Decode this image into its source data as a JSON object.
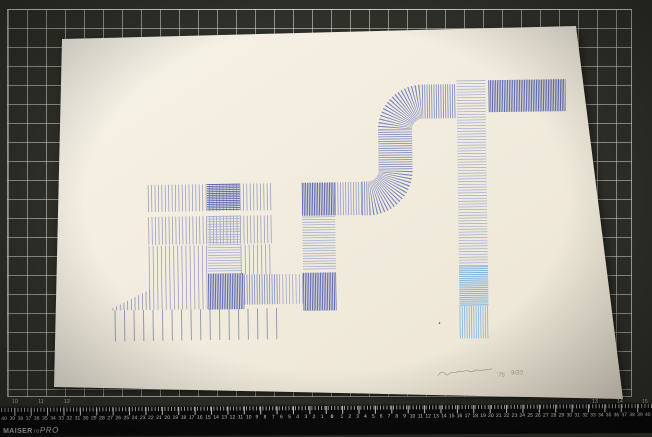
{
  "mat": {
    "base_color": "#31312b",
    "grid_line_color": "#e4e4d8",
    "scale_numbers_left": [
      "10",
      "11",
      "12"
    ],
    "scale_numbers_right": [
      "13",
      "14",
      "15"
    ]
  },
  "ruler": {
    "brand_bold": "MAISER",
    "brand_mid": "re",
    "brand_italic": "PRO",
    "center_label": "0",
    "numbers_left": [
      "40",
      "39",
      "38",
      "37",
      "36",
      "35",
      "34",
      "33",
      "32",
      "31",
      "30",
      "29",
      "28",
      "27",
      "26",
      "25",
      "24",
      "23",
      "22",
      "21",
      "20",
      "19",
      "18",
      "17",
      "16",
      "15",
      "14",
      "13",
      "12",
      "11",
      "10",
      "9",
      "8",
      "7",
      "6",
      "5",
      "4",
      "3",
      "2",
      "1"
    ],
    "numbers_right": [
      "1",
      "2",
      "3",
      "4",
      "5",
      "6",
      "7",
      "8",
      "9",
      "10",
      "11",
      "12",
      "13",
      "14",
      "15",
      "16",
      "17",
      "18",
      "19",
      "20",
      "21",
      "22",
      "23",
      "24",
      "25",
      "26",
      "27",
      "28",
      "29",
      "30",
      "31",
      "32",
      "33",
      "34",
      "35",
      "36",
      "37",
      "38",
      "39",
      "40"
    ]
  },
  "paper": {
    "color_light": "#f6f1e5",
    "color_dark": "#eee8d8",
    "corners": "62,39 576,26 623,399 54,387"
  },
  "artwork": {
    "ink_colors": {
      "dark_periwinkle": "#5560ab",
      "medium_periwinkle": "#7d88c2",
      "light_periwinkle": "#9aa6cf",
      "pale_blue_gray": "#8e99bb",
      "sky_blue": "#79b0e0"
    },
    "signature": {
      "year": "'75",
      "edition": "9/20"
    },
    "strokes": [
      {
        "name": "left-row1-sparse-vertical-lines",
        "x1": 148,
        "y1": 195.5,
        "x2": 272,
        "y2": 195.5,
        "w": 27,
        "dash": "0.7 2.7",
        "color": "#8e99bb"
      },
      {
        "name": "left-row1-dark-horizontal-hatch",
        "x1": 223.5,
        "y1": 182,
        "x2": 223.5,
        "y2": 209,
        "w": 33,
        "dash": "0.9 0.9",
        "color": "#5560ab"
      },
      {
        "name": "left-row2-sparse-vertical-lines",
        "x1": 148,
        "y1": 228,
        "x2": 272,
        "y2": 228,
        "w": 28,
        "dash": "0.7 2.7",
        "color": "#8e99bb"
      },
      {
        "name": "left-center-light-horizontal-hatch",
        "x1": 223.5,
        "y1": 214,
        "x2": 223.5,
        "y2": 270,
        "w": 33,
        "dash": "0.7 1.9",
        "color": "#9aa6cf"
      },
      {
        "name": "left-row3-tall-sparse-vertical-lines",
        "x1": 148,
        "y1": 275,
        "x2": 207,
        "y2": 275,
        "w": 64,
        "dash": "0.7 3.4",
        "color": "#8e99bb"
      },
      {
        "name": "left-row3-right-sparse-vertical-lines",
        "x1": 240,
        "y1": 258,
        "x2": 272,
        "y2": 258,
        "w": 30,
        "dash": "0.7 3.4",
        "color": "#8e99bb"
      },
      {
        "name": "left-center-dark-vertical-hatch",
        "x1": 207,
        "y1": 289.5,
        "x2": 243,
        "y2": 289.5,
        "w": 36,
        "dash": "0.9 0.8",
        "color": "#5560ab"
      },
      {
        "name": "left-connector-band-dense",
        "x1": 243,
        "y1": 288,
        "x2": 278,
        "y2": 288,
        "w": 30,
        "dash": "0.8 1.7",
        "color": "#7d88c2"
      },
      {
        "name": "left-connector-band-light",
        "x1": 278,
        "y1": 288,
        "x2": 302,
        "y2": 288,
        "w": 30,
        "dash": "0.7 2.6",
        "color": "#97a0c6"
      },
      {
        "name": "bottom-row-sparse-vertical-lines",
        "x1": 113,
        "y1": 322.5,
        "x2": 278,
        "y2": 322.5,
        "w": 31,
        "dash": "0.9 8.6",
        "color": "#8a94b0"
      },
      {
        "name": "bottom-left-staircase-lines",
        "x1": 111,
        "y1": 296,
        "x2": 150,
        "y2": 296,
        "w": 22,
        "dash": "0.8 2.9",
        "color": "#8a94b0",
        "clip": "stair-clip"
      },
      {
        "name": "middle-band-dark-vertical-hatch",
        "x1": 302,
        "y1": 198.5,
        "x2": 335,
        "y2": 198.5,
        "w": 33,
        "dash": "0.9 0.8",
        "color": "#5560ab"
      },
      {
        "name": "middle-band-light-vertical-hatch",
        "x1": 335,
        "y1": 198.5,
        "x2": 363,
        "y2": 198.5,
        "w": 33,
        "dash": "0.8 1.8",
        "color": "#8f9ac8"
      },
      {
        "name": "middle-column-horizontal-hatch",
        "x1": 318.5,
        "y1": 216,
        "x2": 318.5,
        "y2": 270,
        "w": 33,
        "dash": "0.7 1.9",
        "color": "#9aa6cf"
      },
      {
        "name": "middle-column-dark-vertical-hatch",
        "x1": 302,
        "y1": 291,
        "x2": 335,
        "y2": 291,
        "w": 38,
        "dash": "0.9 0.8",
        "color": "#5560ab"
      },
      {
        "name": "s-pipe-hatched-curve",
        "d": "M 362 198.5 H 368 A 28 28 0 0 0 396 170.5 L 396 130.5 A 28 28 0 0 1 424 102.5 H 458",
        "w": 34,
        "dash": "0.8 1.5",
        "color": "#7a85c0"
      },
      {
        "name": "right-column-light-horizontal-hatch",
        "x1": 472.5,
        "y1": 82,
        "x2": 472.5,
        "y2": 268,
        "w": 29,
        "dash": "0.7 2.1",
        "color": "#9fabd0"
      },
      {
        "name": "top-band-dark-vertical-hatch",
        "x1": 490,
        "y1": 98,
        "x2": 567,
        "y2": 98,
        "w": 32,
        "dash": "0.9 0.8",
        "color": "#5560ab"
      },
      {
        "name": "right-column-sky-horizontal-hatch",
        "x1": 472.5,
        "y1": 268,
        "x2": 472.5,
        "y2": 307,
        "w": 29,
        "dash": "0.9 1.0",
        "color": "#79b0e0"
      },
      {
        "name": "right-column-sky-vertical-hatch",
        "x1": 458,
        "y1": 323.5,
        "x2": 487,
        "y2": 323.5,
        "w": 33,
        "dash": "0.8 1.5",
        "color": "#7fb4e2"
      },
      {
        "name": "small-ink-dot",
        "x1": 437,
        "y1": 324,
        "x2": 438.4,
        "y2": 324.5,
        "w": 1.6,
        "dash": "4",
        "color": "#6e695e"
      }
    ]
  }
}
